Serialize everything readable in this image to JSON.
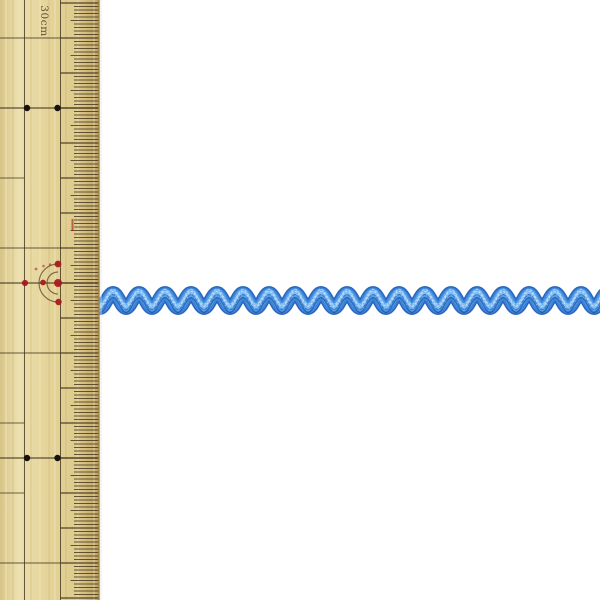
{
  "scene": {
    "alt": "Blue ric-rac zigzag ribbon trim photographed beside a 30cm bamboo ruler on a white background",
    "background_color": "#ffffff"
  },
  "ruler": {
    "label": "30cm",
    "unit": "cm",
    "colors": {
      "body_edge_left": "#d8c487",
      "body_light": "#ecdfae",
      "body_mid": "#e4d398",
      "body_shade": "#ddcb8d",
      "body_dark": "#cdb274",
      "body_edge_right": "#b89e61",
      "edge_line": "#9c8142",
      "tick": "#42361f",
      "black_dot": "#17120d",
      "red_mark": "#a8151d",
      "arc": "#5a4a33",
      "label_text": "#4f3f26",
      "grain_light": "#f2e6b8",
      "grain_dark": "#c9b273",
      "shadow": "#e6e6df"
    },
    "geometry": {
      "width_px": 99.5,
      "height_px": 600,
      "cm_px": 35,
      "mm_px": 3.5,
      "origin_y": 3,
      "cm_count": 18,
      "v_line1_x": 24.5,
      "v_line2_x": 60.5,
      "mm_tick_x": 74,
      "half_cm_tick_x": 70.5,
      "cm_tick_x": 60.5,
      "right_x": 98.5
    },
    "rows": {
      "left_short": [
        5,
        12,
        14
      ],
      "left_long": [
        1,
        7,
        10,
        16
      ],
      "full": [
        3,
        8,
        13
      ]
    },
    "black_dots": [
      {
        "x": 27,
        "y": 108
      },
      {
        "x": 57.5,
        "y": 108
      },
      {
        "x": 27,
        "y": 458
      },
      {
        "x": 57.5,
        "y": 458
      }
    ],
    "red_mark": {
      "center": {
        "x": 58,
        "y": 283
      },
      "dots": [
        {
          "x": 58,
          "y": 283,
          "r": 4.0
        },
        {
          "x": 58,
          "y": 264,
          "r": 3.4
        },
        {
          "x": 58.5,
          "y": 302,
          "r": 3.2
        },
        {
          "x": 43,
          "y": 282.5,
          "r": 2.9
        },
        {
          "x": 25,
          "y": 283,
          "r": 3.1
        },
        {
          "x": 36,
          "y": 269,
          "r": 1.4
        },
        {
          "x": 43.5,
          "y": 266,
          "r": 1.3
        },
        {
          "x": 50,
          "y": 264.5,
          "r": 1.2
        }
      ],
      "arc_radii": [
        11,
        19
      ],
      "dash": {
        "x": 72.5,
        "y1": 219,
        "y2": 231
      }
    },
    "grain_lines": [
      [
        6,
        2,
        "light",
        0.5
      ],
      [
        13,
        1.5,
        "dark",
        0.35
      ],
      [
        20,
        2.5,
        "light",
        0.4
      ],
      [
        31,
        1.5,
        "dark",
        0.3
      ],
      [
        40,
        2,
        "light",
        0.45
      ],
      [
        49,
        1.5,
        "dark",
        0.3
      ],
      [
        55,
        2,
        "light",
        0.4
      ],
      [
        66,
        2,
        "dark",
        0.28
      ],
      [
        78,
        2,
        "light",
        0.35
      ],
      [
        88,
        1.5,
        "dark",
        0.3
      ],
      [
        94,
        2,
        "light",
        0.4
      ]
    ]
  },
  "ribbon": {
    "type": "ric-rac zigzag trim",
    "color_main": "#3c85da",
    "geometry": {
      "center_y": 300.5,
      "amplitude": 7.5,
      "period_px": 26,
      "first_peak_x": 113,
      "start_x": 92,
      "end_x": 612,
      "tape_width": 13.5
    },
    "layers": [
      {
        "dy": 0,
        "width": 14,
        "color": "#2a66bf",
        "opacity": 1
      },
      {
        "dy": 0,
        "width": 11,
        "color": "#3c85da",
        "opacity": 1
      },
      {
        "dy": -0.5,
        "width": 7.5,
        "color": "#5ca2e8",
        "opacity": 1
      },
      {
        "dy": -1,
        "width": 3.5,
        "color": "#86c0f3",
        "opacity": 0.9
      },
      {
        "dy": -3.8,
        "width": 1.2,
        "color": "#aed7f9",
        "opacity": 0.85,
        "dash": "2 2.2"
      },
      {
        "dy": -1.8,
        "width": 1,
        "color": "#d3eafc",
        "opacity": 0.8,
        "dash": "1.4 2.6"
      },
      {
        "dy": 1.6,
        "width": 1.1,
        "color": "#2d6cc4",
        "opacity": 0.8,
        "dash": "3 2"
      },
      {
        "dy": 4.6,
        "width": 1.3,
        "color": "#1f55a6",
        "opacity": 0.75
      }
    ]
  }
}
